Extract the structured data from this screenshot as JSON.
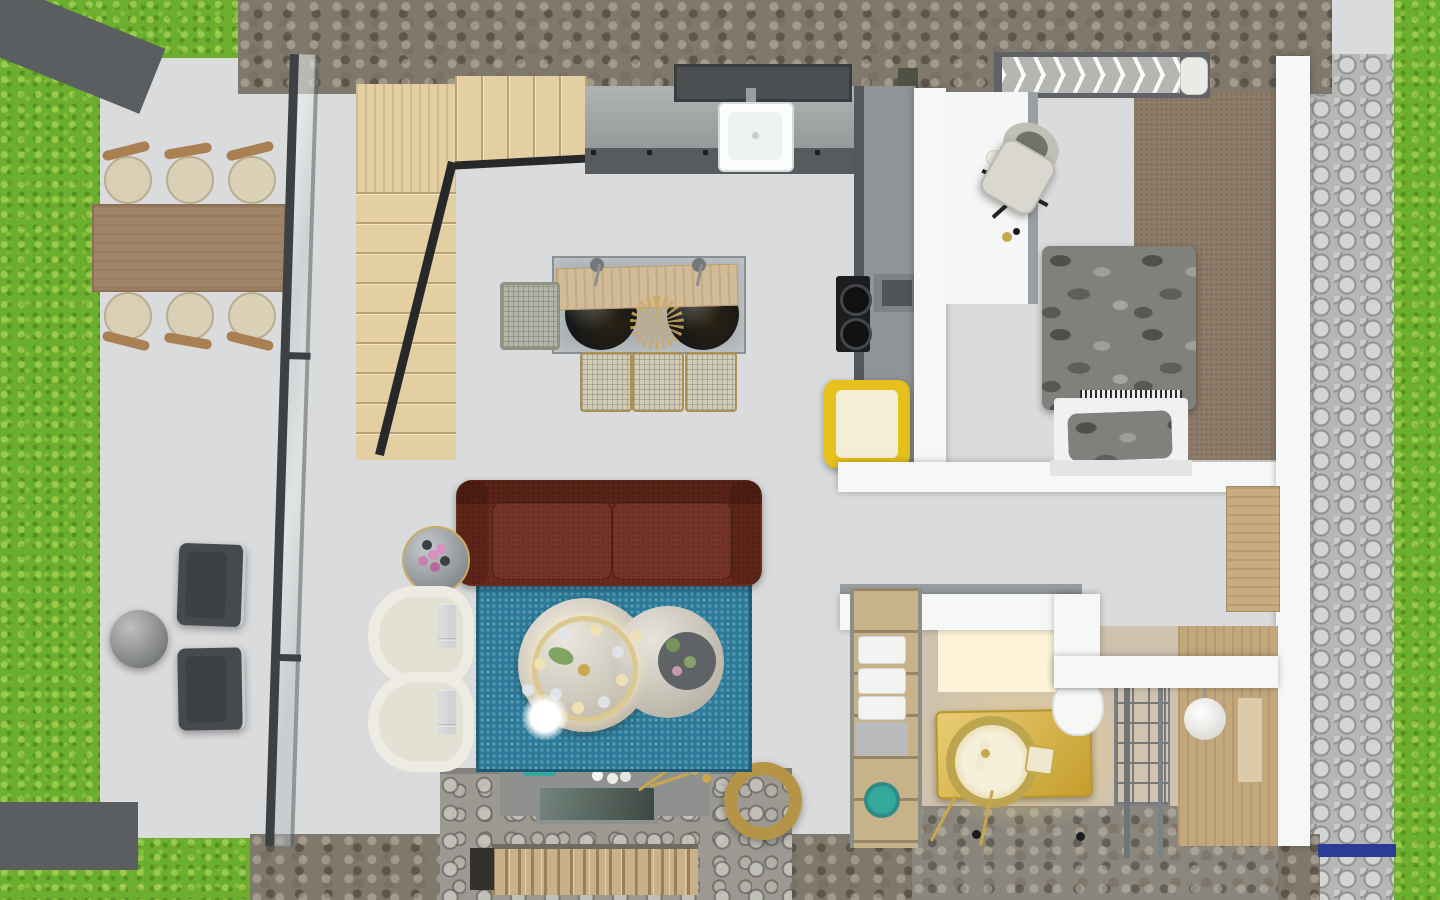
{
  "scene": {
    "type": "3d-floor-plan-top-view",
    "width": 1440,
    "height": 900,
    "areas": [
      "lawn",
      "patio-terrace",
      "staircase",
      "kitchen",
      "dining-area",
      "living-room",
      "bedroom",
      "hallway",
      "bathroom",
      "shower-room",
      "entry",
      "stone-path"
    ],
    "objects": [
      "outdoor-dining-table",
      "outdoor-chairs",
      "lounge-chairs",
      "lounge-side-table",
      "glass-partition",
      "staircase",
      "kitchen-counter",
      "range-hood",
      "kitchen-sink",
      "cooktop",
      "open-shelf-box",
      "yellow-refrigerator",
      "island-table",
      "pendant-lamps",
      "bar-stools",
      "sofa",
      "area-rug",
      "coffee-tables",
      "ring-chandelier",
      "floor-lamp-glow",
      "flower-side-table",
      "wicker-armchairs",
      "fireplace-hearth",
      "glass-fire-pit",
      "gong-ornament",
      "firewood-logs",
      "bed",
      "duvet",
      "pillow",
      "desk",
      "office-chair",
      "chevron-bench",
      "wardrobe-carpet",
      "towel-ladder",
      "gold-vanity",
      "round-gold-sink",
      "toilet",
      "shower-screen",
      "pendant-light",
      "wall-niche",
      "entry-bench",
      "doormat-blue"
    ]
  },
  "palette": {
    "tile": "#d9dbdc",
    "grass": "#6cae2d",
    "stone": "#7f786c",
    "cobble": "#b4b7b3",
    "wall_white": "#f6f7f7",
    "wall_edge": "#989da0",
    "beam_dark": "#5b5e60",
    "glass_frame": "#3e4144",
    "rail": "#26282a",
    "wood_stair": "#e4cfa2",
    "wood_runner": "#d2bc97",
    "patio_table": "#a08467",
    "patio_chair": "#d9d0b6",
    "chair_arm": "#aa7f52",
    "counter": "#a2a6a7",
    "counter_front": "#575b5d",
    "counter_side": "#8f9496",
    "olive": "#4d5244",
    "hood": "#4b4f51",
    "sink_white": "#fbfcfc",
    "cooktop": "#1b1d1e",
    "shelf_box": "#7d8284",
    "yellow": "#e6c01c",
    "cream": "#f4eed7",
    "island_glass": "#aab1b4",
    "pendant_black": "#141617",
    "stool_wicker": "#d0ccb6",
    "stool_gray": "#b4b4a8",
    "sofa": "#6d2b1d",
    "rug": "#2b7a99",
    "table_cream": "#dad3c3",
    "table_cream2": "#d5cec0",
    "table_inner": "#5f6365",
    "gold": "#c9a84c",
    "glow": "#fdf3d8",
    "wicker": "#e3e0d4",
    "side_table": "#989ea2",
    "flower_pink": "#d98fc0",
    "lounge": "#46494e",
    "lounge_cushion": "#3c3f44",
    "lounge_table": "#898c8d",
    "bed_camo": "#7e817c",
    "mattress": "#f0f1f1",
    "bed_base": "#e3e5e5",
    "carpet": "#8c7c69",
    "bench_frame": "#5f6366",
    "bench_cushion": "#b3b6b1",
    "pillow_roll": "#eaeae6",
    "desk": "#f5f6f6",
    "desk_edge": "#9aa0a2",
    "chair_seat": "#d9d7cf",
    "chair_back": "#bfc1b6",
    "bath_wall": "#cfc2ae",
    "shower_wood": "#c3a87e",
    "niche": "#dccaa8",
    "vanity": "#dfb73a",
    "teal": "#35a89d",
    "towel_wood": "#c8b28a",
    "towel": "#f3f3f1",
    "box_gray": "#b9babc",
    "toilet": "#f7f8f6",
    "lamp_white": "#f2f2ee",
    "stone_floor": "#8a867d",
    "hearth": "#9b9992",
    "hearth_pad": "#8e918e",
    "glass_green": "#4e6157",
    "blue_mat": "#2a3c96",
    "bench_entry": "#c8ab80",
    "log": "#c9b187",
    "log_gap": "#33312c",
    "dark_dot": "#1b1c1d",
    "chrome": "#c7ccd1"
  }
}
